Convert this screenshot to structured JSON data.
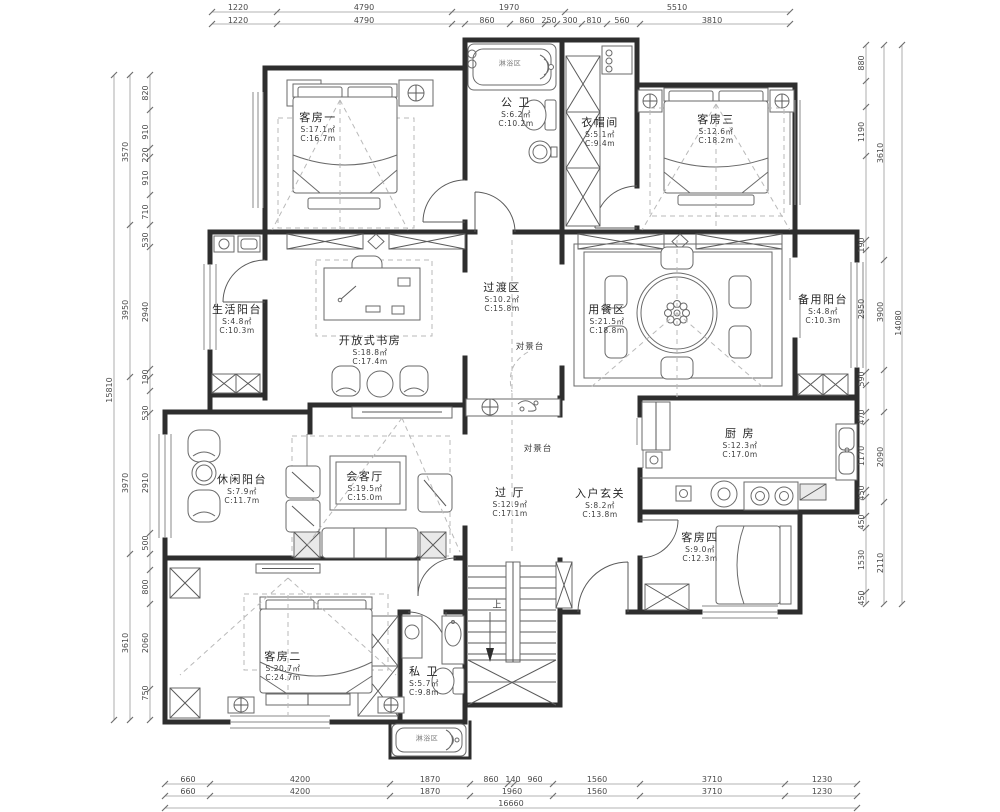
{
  "rooms": [
    {
      "name": "客房一",
      "s": "S:17.1㎡",
      "c": "C:16.7m"
    },
    {
      "name": "公 卫",
      "s": "S:6.2㎡",
      "c": "C:10.2m"
    },
    {
      "name": "衣帽间",
      "s": "S:5.1㎡",
      "c": "C:9.4m"
    },
    {
      "name": "客房三",
      "s": "S:12.6㎡",
      "c": "C:18.2m"
    },
    {
      "name": "生活阳台",
      "s": "S:4.8㎡",
      "c": "C:10.3m"
    },
    {
      "name": "开放式书房",
      "s": "S:18.8㎡",
      "c": "C:17.4m"
    },
    {
      "name": "过渡区",
      "s": "S:10.2㎡",
      "c": "C:15.8m"
    },
    {
      "name": "用餐区",
      "s": "S:21.5㎡",
      "c": "C:18.8m"
    },
    {
      "name": "备用阳台",
      "s": "S:4.8㎡",
      "c": "C:10.3m"
    },
    {
      "name": "休闲阳台",
      "s": "S:7.9㎡",
      "c": "C:11.7m"
    },
    {
      "name": "会客厅",
      "s": "S:19.5㎡",
      "c": "C:15.0m"
    },
    {
      "name": "过 厅",
      "s": "S:12.9㎡",
      "c": "C:17.1m"
    },
    {
      "name": "入户玄关",
      "s": "S:8.2㎡",
      "c": "C:13.8m"
    },
    {
      "name": "厨 房",
      "s": "S:12.3㎡",
      "c": "C:17.0m"
    },
    {
      "name": "客房四",
      "s": "S:9.0㎡",
      "c": "C:12.3m"
    },
    {
      "name": "客房二",
      "s": "S:20.7㎡",
      "c": "C:24.7m"
    },
    {
      "name": "私 卫",
      "s": "S:5.7㎡",
      "c": "C:9.8m"
    }
  ],
  "annotations": {
    "view_stand": "对景台",
    "shower_zone": "淋浴区",
    "stair_up": "上"
  },
  "dims": {
    "top1": [
      "1220",
      "4790",
      "1970",
      "5510"
    ],
    "top2": [
      "1220",
      "4790",
      "860",
      "860",
      "250",
      "300",
      "810",
      "560",
      "3810"
    ],
    "bottom1": [
      "660",
      "4200",
      "1870",
      "860",
      "140",
      "960",
      "1560",
      "3710",
      "1230"
    ],
    "bottom2": [
      "660",
      "4200",
      "1870",
      "1960",
      "1560",
      "3710",
      "1230"
    ],
    "bottom_total": "16660",
    "left_inner": [
      "820",
      "910",
      "220",
      "910",
      "710",
      "530",
      "2940",
      "190",
      "530",
      "2910",
      "500",
      "800",
      "2060",
      "750"
    ],
    "left_groups": [
      "3570",
      "3950",
      "3970",
      "3610"
    ],
    "left_total": "15810",
    "right_inner": [
      "880",
      "1190",
      "190",
      "2950",
      "590",
      "470",
      "1170",
      "450",
      "450",
      "1530",
      "450"
    ],
    "right_groups": [
      "3610",
      "3900",
      "2090",
      "2110"
    ],
    "right_total": "14080"
  },
  "colors": {
    "wall": "#2e2e2e",
    "furniture_line": "#6a6a6a",
    "dimension_line": "#9a9a9a",
    "text": "#2b2b2b",
    "background": "#ffffff"
  }
}
